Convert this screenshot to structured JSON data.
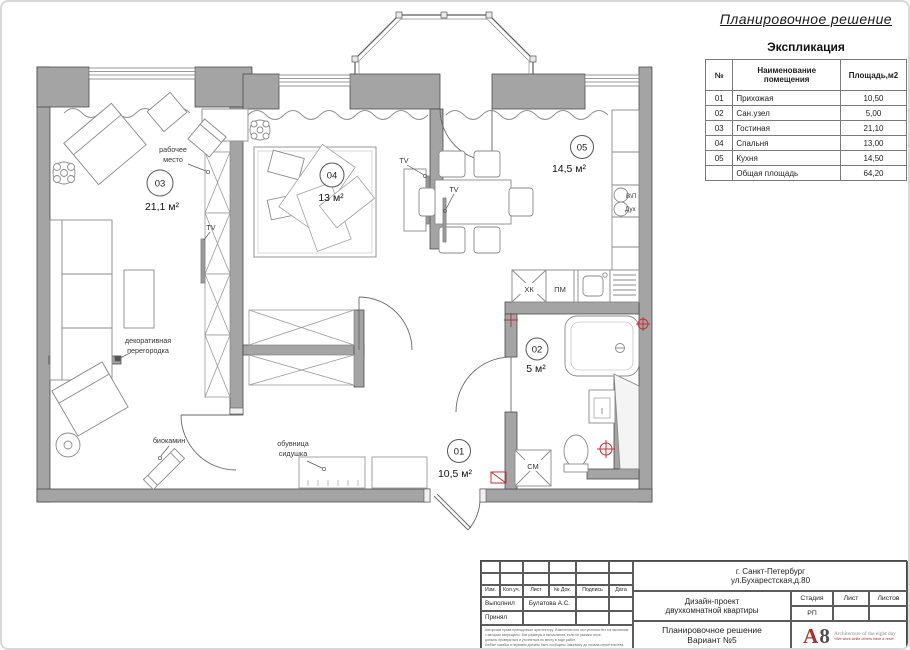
{
  "page": {
    "title": "Планировочное решение"
  },
  "explication": {
    "title": "Экспликация",
    "col_num": "№",
    "col_name": "Наименование помещения",
    "col_area": "Площадь,м2",
    "rows": [
      {
        "num": "01",
        "name": "Прихожая",
        "area": "10,50"
      },
      {
        "num": "02",
        "name": "Сан.узел",
        "area": "5,00"
      },
      {
        "num": "03",
        "name": "Гостиная",
        "area": "21,10"
      },
      {
        "num": "04",
        "name": "Спальня",
        "area": "13,00"
      },
      {
        "num": "05",
        "name": "Кухня",
        "area": "14,50"
      }
    ],
    "total_label": "Общая площадь",
    "total_area": "64,20"
  },
  "plan": {
    "rooms": {
      "r01": {
        "num": "01",
        "area": "10,5 м²"
      },
      "r02": {
        "num": "02",
        "area": "5 м²"
      },
      "r03": {
        "num": "03",
        "area": "21,1 м²"
      },
      "r04": {
        "num": "04",
        "area": "13 м²"
      },
      "r05": {
        "num": "05",
        "area": "14,5 м²"
      }
    },
    "labels": {
      "workplace_1": "рабочее",
      "workplace_2": "место",
      "tv": "TV",
      "decor_1": "декоративная",
      "decor_2": "перегородка",
      "biofireplace": "биокамин",
      "shoe_1": "обувница",
      "shoe_2": "сидушка",
      "fridge": "ХК",
      "dishwasher": "ПМ",
      "vent_1": "В\\П",
      "vent_2": "Дух",
      "washer": "СМ"
    },
    "colors": {
      "wall": "#a4a4a4",
      "accent_red": "#bf3434"
    }
  },
  "titleblock": {
    "address_1": "г. Санкт-Петербург",
    "address_2": "ул.Бухарестская,д.80",
    "cols": {
      "izm": "Изм.",
      "koluch": "Кол.уч.",
      "list": "Лист",
      "ndok": "№ Док.",
      "podpis": "Подпись",
      "data": "Дата"
    },
    "performed_label": "Выполнил",
    "performed_value": "Булатова А.С.",
    "accepted_label": "Принял",
    "project_1": "Дизайн-проект",
    "project_2": "двухкомнатной квартиры",
    "stage_label": "Стадия",
    "sheet_label": "Лист",
    "sheets_label": "Листов",
    "stage_value": "РП",
    "drawing_1": "Планировочное решение",
    "drawing_2": "Вариант №5",
    "logo_a": "A",
    "logo_8": "8",
    "logo_text": "Architecture of the eight day",
    "logo_tagline": "«We work while others have a rest»",
    "fine_1": "Авторские права принадлежат архитектору. Изменения или отступления без согласования",
    "fine_2": "с автором запрещены. Все размеры и вычисления, если не указано иное,",
    "fine_3": "должны проверяться и уточняться по месту в ходе работ.",
    "fine_4": "Любые ошибки и неувязки должны быть сообщены Заказчику до начала строительства."
  }
}
